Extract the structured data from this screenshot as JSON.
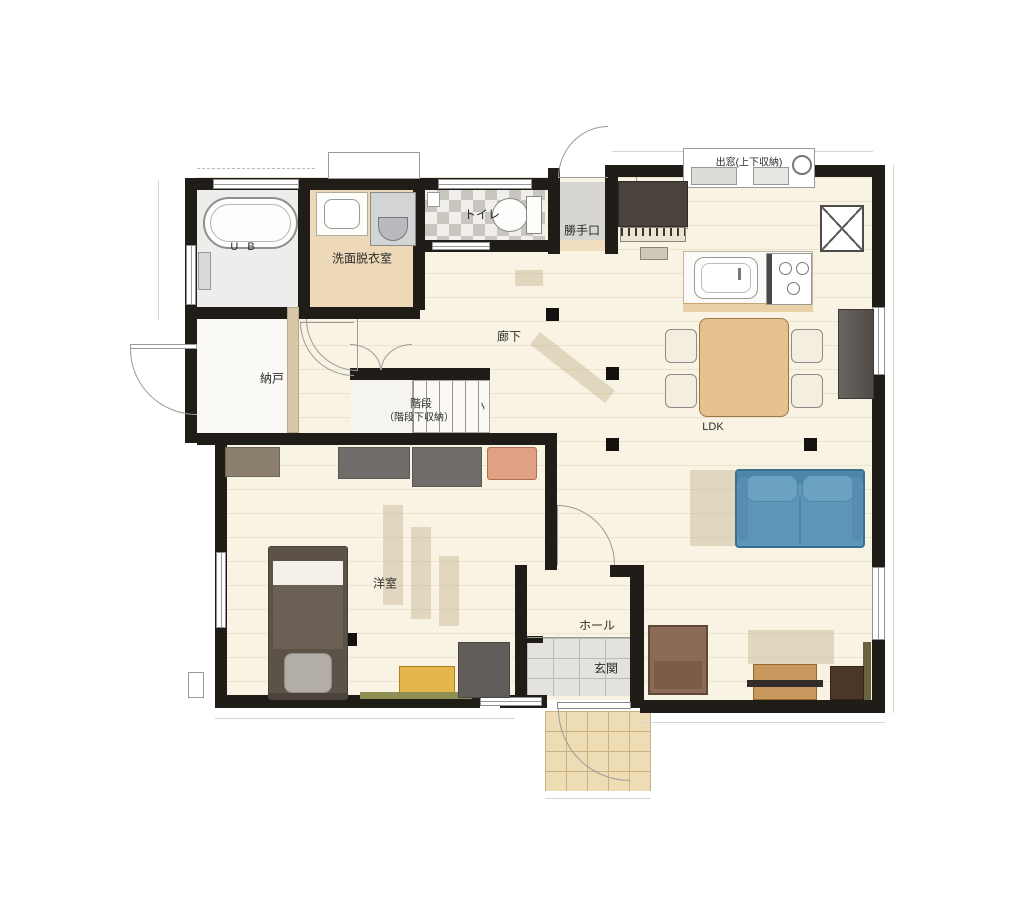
{
  "rooms": {
    "bath": "U B",
    "washroom": "洗面脱衣室",
    "toilet": "トイレ",
    "backdoor": "勝手口",
    "bay_window": "出窓(上下収納)",
    "corridor": "廊下",
    "storage": "納戸",
    "stairs": "階段",
    "stairs_sub": "（階段下収納）",
    "ldk": "LDK",
    "bedroom": "洋室",
    "hall": "ホール",
    "entrance": "玄関"
  },
  "marks": {
    "stair_break": "∽"
  },
  "colors": {
    "wall": "#201d19",
    "floor_wood": "#f8f3e2",
    "washroom_floor": "#edd8b8",
    "toilet_tile_dark": "#c9c6c0",
    "backdoor_floor": "#d7d6d3",
    "genkan_tile": "#e4e2de",
    "porch_tile": "#eddcb4",
    "sofa_blue": "#5e96b9",
    "dining_table_wood": "#e7c28e",
    "bed_brown": "#5c5247",
    "chair_orange": "#e0a083",
    "desk_yellow": "#e5b64e",
    "piano_dark": "#4a423d"
  }
}
